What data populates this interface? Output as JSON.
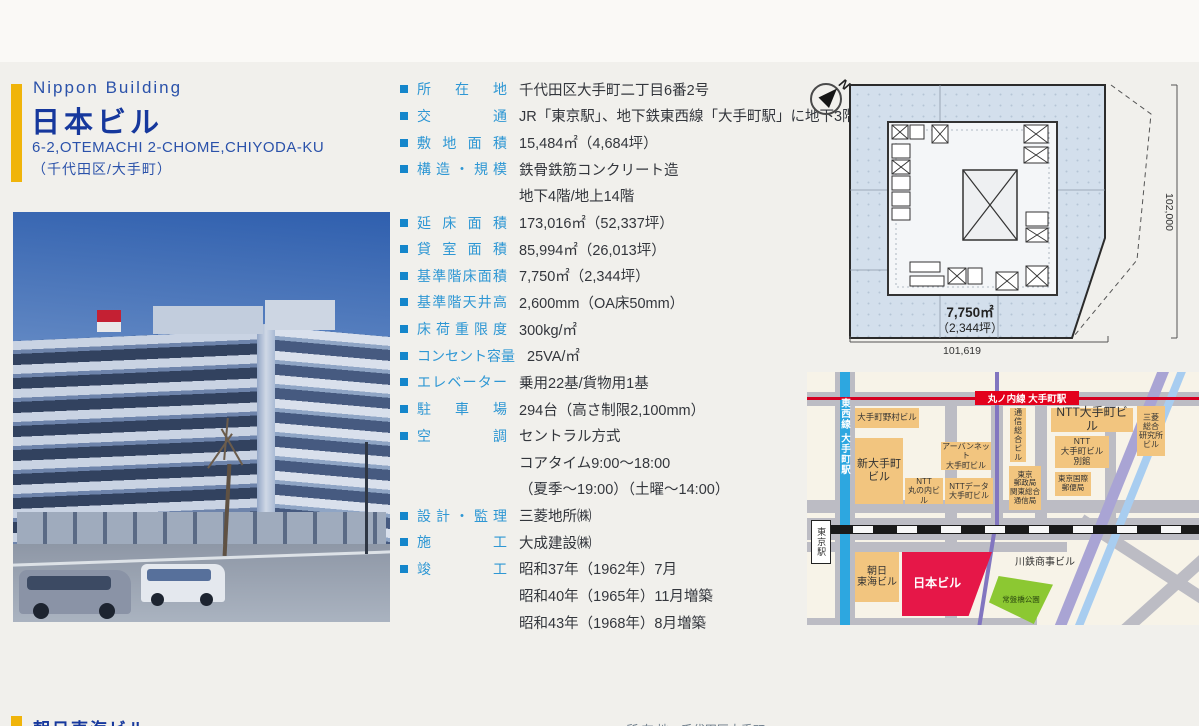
{
  "colors": {
    "accent_yellow": "#f0b40a",
    "title_blue": "#16389d",
    "header_blue": "#2b52aa",
    "spec_label_blue": "#2e97d4",
    "spec_bullet_blue": "#1586cb",
    "map_subject_red": "#e61748",
    "map_building_tan": "#f2c57f",
    "map_park_green": "#8cc832",
    "marunouchi_red": "#e3001c",
    "tozai_blue": "#2da7e0",
    "plan_site_blue": "#d3dfec"
  },
  "header": {
    "name_en": "Nippon Building",
    "name_ja": "日本ビル",
    "address_en": "6-2,OTEMACHI 2-CHOME,CHIYODA-KU",
    "address_ja": "（千代田区/大手町）"
  },
  "specs": [
    {
      "label": "所在地",
      "lines": [
        "千代田区大手町二丁目6番2号"
      ]
    },
    {
      "label": "交通",
      "lines": [
        "JR「東京駅」、地下鉄東西線「大手町駅」に地下3階で直結"
      ]
    },
    {
      "label": "敷地面積",
      "lines": [
        "15,484㎡（4,684坪）"
      ]
    },
    {
      "label": "構造・規模",
      "lines": [
        "鉄骨鉄筋コンクリート造",
        "地下4階/地上14階"
      ]
    },
    {
      "label": "延床面積",
      "lines": [
        "173,016㎡（52,337坪）"
      ]
    },
    {
      "label": "貸室面積",
      "lines": [
        "85,994㎡（26,013坪）"
      ]
    },
    {
      "label": "基準階床面積",
      "lines": [
        "7,750㎡（2,344坪）"
      ]
    },
    {
      "label": "基準階天井高",
      "lines": [
        "2,600mm（OA床50mm）"
      ]
    },
    {
      "label": "床荷重限度",
      "lines": [
        "300kg/㎡"
      ]
    },
    {
      "label": "コンセント容量",
      "lines": [
        "25VA/㎡"
      ]
    },
    {
      "label": "エレベーター",
      "lines": [
        "乗用22基/貨物用1基"
      ]
    },
    {
      "label": "駐車場",
      "lines": [
        "294台（高さ制限2,100mm）"
      ]
    },
    {
      "label": "空調",
      "lines": [
        "セントラル方式",
        "コアタイム9:00～18:00",
        "（夏季～19:00）（土曜～14:00）"
      ]
    },
    {
      "label": "設計・監理",
      "lines": [
        "三菱地所㈱"
      ]
    },
    {
      "label": "施工",
      "lines": [
        "大成建設㈱"
      ]
    },
    {
      "label": "竣工",
      "lines": [
        "昭和37年（1962年）7月",
        "昭和40年（1965年）11月増築",
        "昭和43年（1968年）8月増築"
      ]
    }
  ],
  "floorplan": {
    "north": "N",
    "area": "7,750㎡",
    "area_tsubo": "（2,344坪）",
    "dim_height": "102,000",
    "dim_width": "101,619"
  },
  "map": {
    "marunouchi_label": "丸ノ内線 大手町駅",
    "tozai_label": "東西線 大手町駅",
    "buildings": [
      {
        "id": "otemachi-nomura",
        "kind": "tan",
        "x": 48,
        "y": 36,
        "w": 64,
        "h": 20,
        "fs": 8.5,
        "lines": [
          "大手町野村ビル"
        ]
      },
      {
        "id": "shin-otemachi",
        "kind": "tan",
        "x": 48,
        "y": 66,
        "w": 48,
        "h": 66,
        "fs": 11,
        "lines": [
          "新大手町",
          "ビル"
        ]
      },
      {
        "id": "urbannet-otemachi",
        "kind": "tan",
        "x": 134,
        "y": 70,
        "w": 50,
        "h": 28,
        "fs": 8,
        "lines": [
          "アーバンネット",
          "大手町ビル"
        ]
      },
      {
        "id": "ntt-marunouchi",
        "kind": "tan",
        "x": 98,
        "y": 106,
        "w": 38,
        "h": 26,
        "fs": 8,
        "lines": [
          "NTT",
          "丸の内ビル"
        ]
      },
      {
        "id": "ntt-data-otemachi",
        "kind": "tan",
        "x": 138,
        "y": 106,
        "w": 48,
        "h": 26,
        "fs": 8,
        "lines": [
          "NTTデータ",
          "大手町ビル"
        ]
      },
      {
        "id": "tsushin-sogo",
        "kind": "tan vert",
        "x": 203,
        "y": 36,
        "w": 16,
        "h": 54,
        "fs": 8,
        "lines": [
          "通信総合ビル"
        ]
      },
      {
        "id": "tokyo-yuseikyoku",
        "kind": "tan",
        "x": 202,
        "y": 94,
        "w": 32,
        "h": 44,
        "fs": 7.5,
        "lines": [
          "東京",
          "郵政局",
          "関東総合",
          "通信局"
        ]
      },
      {
        "id": "ntt-otemachi",
        "kind": "tan",
        "x": 244,
        "y": 36,
        "w": 82,
        "h": 24,
        "fs": 12,
        "lines": [
          "NTT大手町ビル"
        ]
      },
      {
        "id": "ntt-otemachi-annex",
        "kind": "tan",
        "x": 248,
        "y": 64,
        "w": 54,
        "h": 32,
        "fs": 8.5,
        "lines": [
          "NTT",
          "大手町ビル",
          "別館"
        ]
      },
      {
        "id": "tokyo-intl-post",
        "kind": "tan",
        "x": 248,
        "y": 100,
        "w": 36,
        "h": 24,
        "fs": 7.5,
        "lines": [
          "東京国際",
          "郵便局"
        ]
      },
      {
        "id": "mitsubishi-research",
        "kind": "tan",
        "x": 330,
        "y": 34,
        "w": 28,
        "h": 50,
        "fs": 8,
        "lines": [
          "三菱",
          "総合",
          "研究所",
          "ビル"
        ]
      },
      {
        "id": "asahi-tokai",
        "kind": "tan",
        "x": 48,
        "y": 180,
        "w": 44,
        "h": 50,
        "fs": 10,
        "lines": [
          "朝日",
          "東海ビル"
        ]
      },
      {
        "id": "nippon-building",
        "kind": "red",
        "x": 95,
        "y": 180,
        "w": 90,
        "h": 64,
        "fs": 12,
        "lines": [
          "日本ビル"
        ]
      },
      {
        "id": "kawatetsu-shoji",
        "kind": "label",
        "x": 196,
        "y": 184,
        "w": 84,
        "h": 14,
        "fs": 10,
        "lines": [
          "川鉄商事ビル"
        ]
      },
      {
        "id": "tokiwabashi-park",
        "kind": "park",
        "x": 182,
        "y": 204,
        "w": 64,
        "h": 48,
        "fs": 7.5,
        "lines": [
          "常盤橋公園"
        ]
      },
      {
        "id": "tokyo-station",
        "kind": "station vert",
        "x": 4,
        "y": 148,
        "w": 18,
        "h": 42,
        "fs": 9,
        "lines": [
          "東京駅"
        ]
      }
    ]
  },
  "partial_next": {
    "title": "朝日東海ビル",
    "spec_fragment": "■所 在 地　千代田区大手町"
  }
}
